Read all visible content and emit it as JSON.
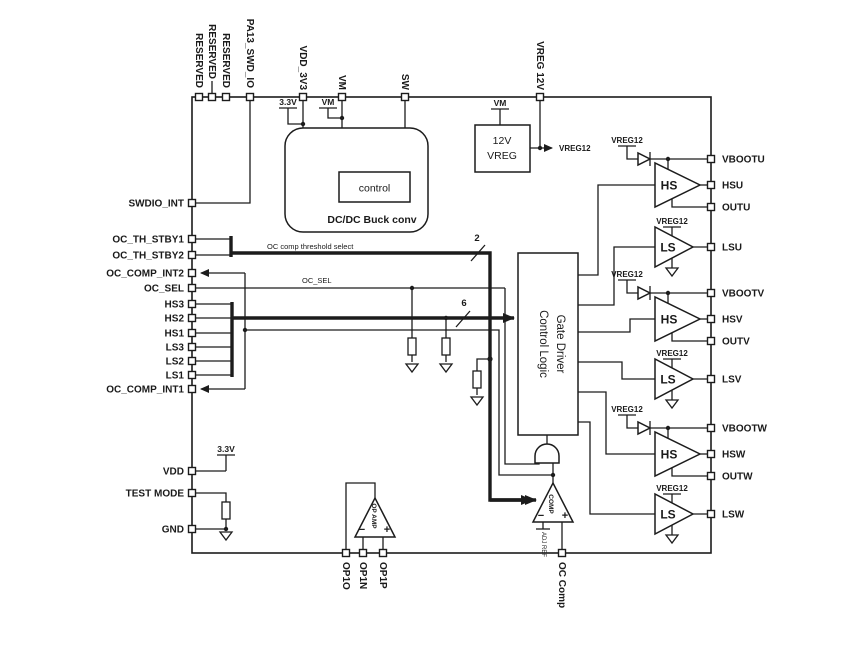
{
  "pins": {
    "top": [
      "RESERVED",
      "RESERVED",
      "RESERVED",
      "PA13_SWD_IO",
      "VDD_3V3",
      "VM",
      "SW",
      "VREG 12V"
    ],
    "left": [
      "SWDIO_INT",
      "OC_TH_STBY1",
      "OC_TH_STBY2",
      "OC_COMP_INT2",
      "OC_SEL",
      "HS3",
      "HS2",
      "HS1",
      "LS3",
      "LS2",
      "LS1",
      "OC_COMP_INT1",
      "VDD",
      "TEST MODE",
      "GND"
    ],
    "right": [
      "VBOOTU",
      "HSU",
      "OUTU",
      "LSU",
      "VBOOTV",
      "HSV",
      "OUTV",
      "LSV",
      "VBOOTW",
      "HSW",
      "OUTW",
      "LSW"
    ],
    "bottom": [
      "OP1O",
      "OP1N",
      "OP1P",
      "OC Comp"
    ]
  },
  "blocks": {
    "buck": {
      "label": "DC/DC Buck conv",
      "control_label": "control"
    },
    "vreg": {
      "line1": "12V",
      "line2": "VREG",
      "output_label": "VREG12"
    },
    "logic": {
      "line1": "Control Logic",
      "line2": "Gate Driver"
    }
  },
  "supplies": {
    "v33": "3.3V",
    "vm": "VM",
    "vreg12": "VREG12"
  },
  "buses": {
    "threshold_label": "OC comp threshold select",
    "threshold_width": "2",
    "input_width": "6",
    "oc_sel_label": "OC_SEL"
  },
  "drivers": {
    "hs": "HS",
    "ls": "LS"
  },
  "analog": {
    "opamp_label": "OP AMP",
    "comp_label": "COMP",
    "adj_ref_label": "ADJ REF",
    "plus": "+",
    "minus": "−"
  },
  "colors": {
    "line": "#1c1c1c",
    "background": "#ffffff"
  }
}
